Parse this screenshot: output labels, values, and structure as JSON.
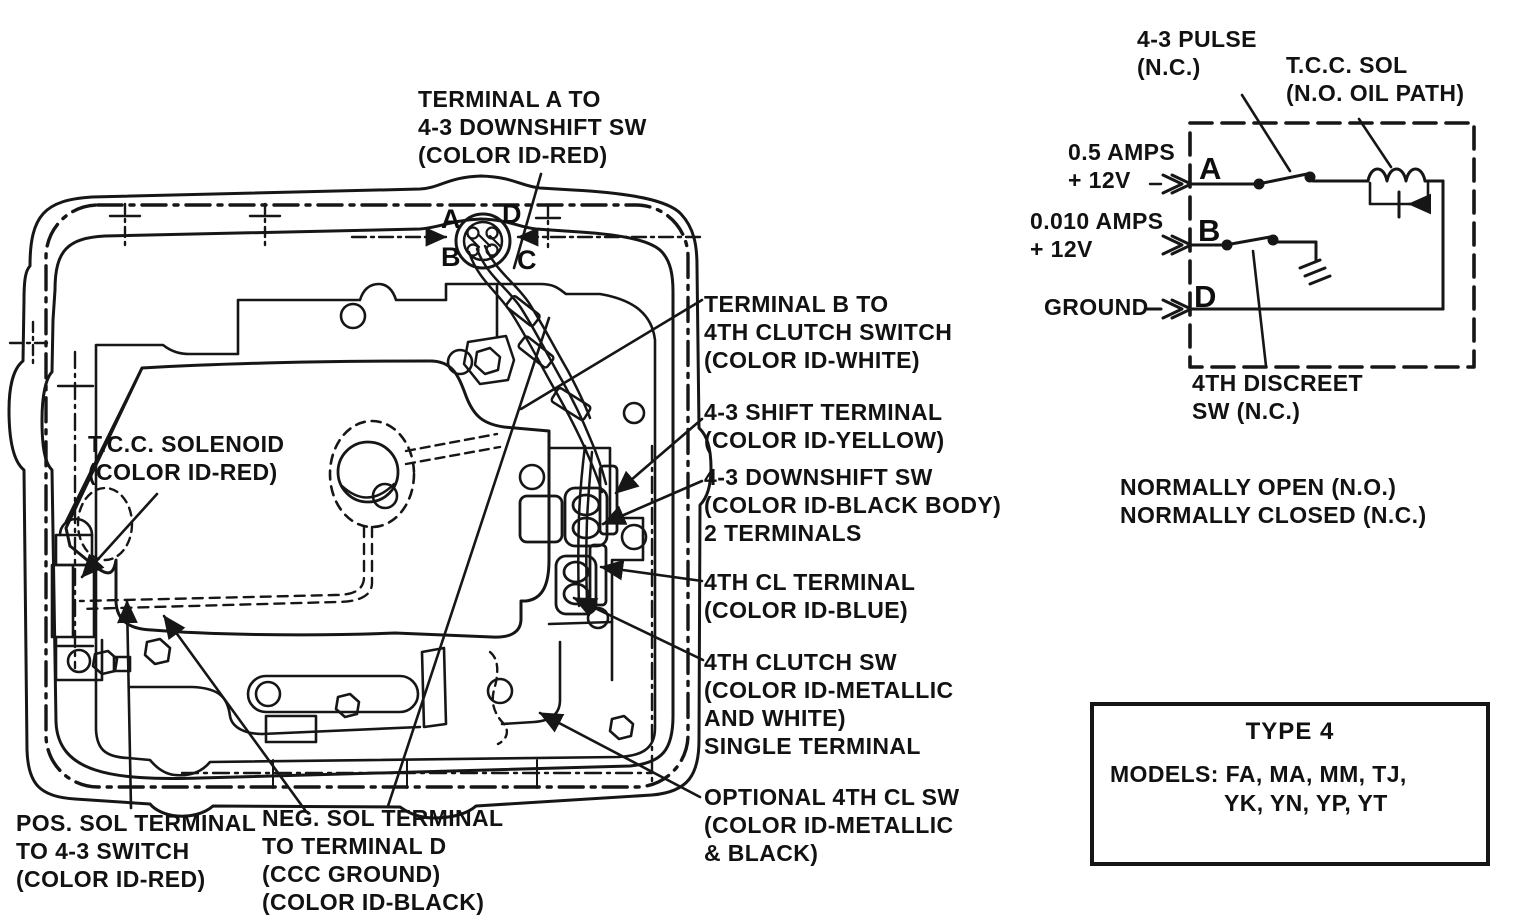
{
  "case_labels": {
    "terminal_a": [
      "TERMINAL A TO",
      "4-3 DOWNSHIFT SW",
      "(COLOR ID-RED)"
    ],
    "tcc_solenoid": [
      "T.C.C. SOLENOID",
      "(COLOR ID-RED)"
    ],
    "pos_sol": [
      "POS. SOL TERMINAL",
      "TO 4-3 SWITCH",
      "(COLOR ID-RED)"
    ],
    "neg_sol": [
      "NEG. SOL TERMINAL",
      "TO TERMINAL D",
      "(CCC GROUND)",
      "(COLOR ID-BLACK)"
    ],
    "terminal_b": [
      "TERMINAL B TO",
      "4TH CLUTCH SWITCH",
      "(COLOR ID-WHITE)"
    ],
    "shift_terminal": [
      "4-3 SHIFT TERMINAL",
      "(COLOR ID-YELLOW)"
    ],
    "downshift_sw": [
      "4-3 DOWNSHIFT SW",
      "(COLOR ID-BLACK BODY)",
      "2 TERMINALS"
    ],
    "cl_terminal": [
      "4TH CL TERMINAL",
      "(COLOR ID-BLUE)"
    ],
    "clutch_sw": [
      "4TH CLUTCH SW",
      "(COLOR ID-METALLIC",
      "AND WHITE)",
      "SINGLE TERMINAL"
    ],
    "optional_sw": [
      "OPTIONAL 4TH CL SW",
      "(COLOR ID-METALLIC",
      "& BLACK)"
    ]
  },
  "connector_pins": {
    "a": "A",
    "b": "B",
    "c": "C",
    "d": "D"
  },
  "circuit": {
    "pulse_label": [
      "4-3 PULSE",
      "(N.C.)"
    ],
    "tcc_sol_label": [
      "T.C.C. SOL",
      "(N.O. OIL PATH)"
    ],
    "amps_a": [
      "0.5 AMPS",
      "+ 12V"
    ],
    "amps_b": [
      "0.010 AMPS",
      "+ 12V"
    ],
    "ground": "GROUND",
    "discreet": [
      "4TH DISCREET",
      "SW (N.C.)"
    ],
    "terminals": {
      "a": "A",
      "b": "B",
      "d": "D"
    },
    "legend": [
      "NORMALLY OPEN (N.O.)",
      "NORMALLY CLOSED (N.C.)"
    ]
  },
  "type_box": {
    "title": "TYPE 4",
    "models_line1": "MODELS: FA, MA, MM, TJ,",
    "models_line2": "YK, YN, YP, YT"
  },
  "colors": {
    "ink": "#161616",
    "paper": "#ffffff"
  }
}
